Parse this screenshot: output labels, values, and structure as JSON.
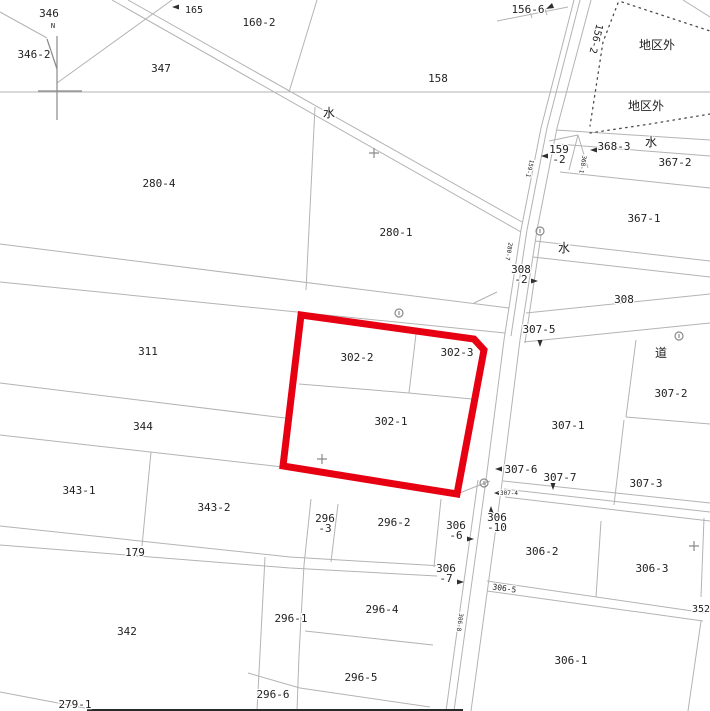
{
  "map": {
    "description": "cadastral parcel map",
    "highlight_outline": {
      "encloses": [
        "302-2",
        "302-3",
        "302-1"
      ]
    },
    "labels": [
      {
        "t": "346",
        "x": 49,
        "y": 17
      },
      {
        "t": "N",
        "x": 53,
        "y": 28,
        "fs": 7
      },
      {
        "t": "346-2",
        "x": 34,
        "y": 58
      },
      {
        "t": "347",
        "x": 161,
        "y": 72
      },
      {
        "t": "165",
        "x": 194,
        "y": 13,
        "fs": 10
      },
      {
        "t": "160-2",
        "x": 259,
        "y": 26
      },
      {
        "t": "158",
        "x": 438,
        "y": 82
      },
      {
        "t": "水",
        "x": 329,
        "y": 117,
        "fs": 12
      },
      {
        "t": "156-6",
        "x": 528,
        "y": 13
      },
      {
        "t": "156-2",
        "x": 593,
        "y": 38,
        "fs": 10,
        "rot": 104
      },
      {
        "t": "地区外",
        "x": 657,
        "y": 49,
        "fs": 12
      },
      {
        "t": "地区外",
        "x": 646,
        "y": 110,
        "fs": 12
      },
      {
        "t": "368-3",
        "x": 614,
        "y": 150
      },
      {
        "t": "水",
        "x": 651,
        "y": 146,
        "fs": 12
      },
      {
        "t": "367-2",
        "x": 675,
        "y": 166
      },
      {
        "t": "368-1",
        "x": 581,
        "y": 164,
        "fs": 6,
        "rot": 100
      },
      {
        "t": "159\n-2",
        "x": 559,
        "y": 153
      },
      {
        "t": "159-1",
        "x": 528,
        "y": 168,
        "fs": 6,
        "rot": 104
      },
      {
        "t": "367-1",
        "x": 644,
        "y": 222
      },
      {
        "t": "水",
        "x": 564,
        "y": 252,
        "fs": 12
      },
      {
        "t": "280-4",
        "x": 159,
        "y": 187
      },
      {
        "t": "280-1",
        "x": 396,
        "y": 236
      },
      {
        "t": "280-7",
        "x": 507,
        "y": 251,
        "fs": 6,
        "rot": 100
      },
      {
        "t": "308\n-2",
        "x": 521,
        "y": 273
      },
      {
        "t": "308",
        "x": 624,
        "y": 303
      },
      {
        "t": "307-5",
        "x": 539,
        "y": 333
      },
      {
        "t": "道",
        "x": 661,
        "y": 357,
        "fs": 12
      },
      {
        "t": "311",
        "x": 148,
        "y": 355
      },
      {
        "t": "302-2",
        "x": 357,
        "y": 361
      },
      {
        "t": "302-3",
        "x": 457,
        "y": 356
      },
      {
        "t": "302-1",
        "x": 391,
        "y": 425
      },
      {
        "t": "344",
        "x": 143,
        "y": 430
      },
      {
        "t": "307-1",
        "x": 568,
        "y": 429
      },
      {
        "t": "307-2",
        "x": 671,
        "y": 397
      },
      {
        "t": "343-1",
        "x": 79,
        "y": 494
      },
      {
        "t": "343-2",
        "x": 214,
        "y": 511
      },
      {
        "t": "307-6",
        "x": 521,
        "y": 473
      },
      {
        "t": "307-7",
        "x": 560,
        "y": 481
      },
      {
        "t": "307-4",
        "x": 509,
        "y": 495,
        "fs": 6
      },
      {
        "t": "307-3",
        "x": 646,
        "y": 487
      },
      {
        "t": "306\n-10",
        "x": 497,
        "y": 521
      },
      {
        "t": "306\n-6",
        "x": 456,
        "y": 529
      },
      {
        "t": "296\n-3",
        "x": 325,
        "y": 522
      },
      {
        "t": "296-2",
        "x": 394,
        "y": 526
      },
      {
        "t": "306-2",
        "x": 542,
        "y": 555
      },
      {
        "t": "306-3",
        "x": 652,
        "y": 572
      },
      {
        "t": "179",
        "x": 135,
        "y": 556
      },
      {
        "t": "306\n-7",
        "x": 446,
        "y": 572
      },
      {
        "t": "306-5",
        "x": 504,
        "y": 591,
        "fs": 8,
        "rot": 8
      },
      {
        "t": "352",
        "x": 701,
        "y": 612,
        "fs": 10
      },
      {
        "t": "296-4",
        "x": 382,
        "y": 613
      },
      {
        "t": "296-1",
        "x": 291,
        "y": 622
      },
      {
        "t": "306-8",
        "x": 458,
        "y": 622,
        "fs": 6,
        "rot": 98
      },
      {
        "t": "342",
        "x": 127,
        "y": 635
      },
      {
        "t": "296-5",
        "x": 361,
        "y": 681
      },
      {
        "t": "306-1",
        "x": 571,
        "y": 664
      },
      {
        "t": "296-6",
        "x": 273,
        "y": 698
      },
      {
        "t": "279-1",
        "x": 75,
        "y": 708
      }
    ]
  },
  "icons": {
    "point_marker": "small-circle",
    "grid_cross": "+",
    "north_mark": "line-with-flag",
    "leader_arrow": "filled-triangle"
  },
  "colors": {
    "highlight": "#e60012",
    "boundary": "#b3b3b3",
    "district_dots": "#4a4a4a",
    "text": "#222222",
    "frame": "#2a2a2a",
    "marker": "#8a8a8a"
  }
}
